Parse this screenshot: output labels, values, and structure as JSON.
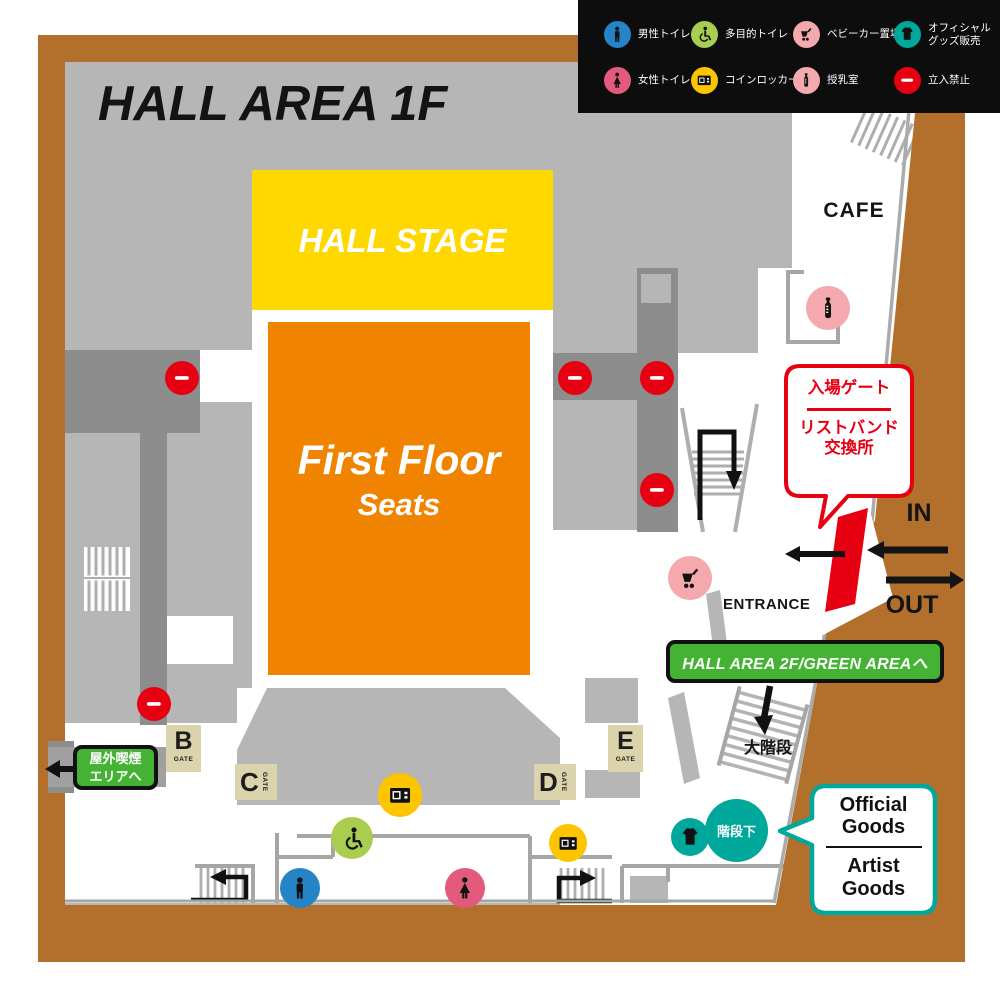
{
  "title": "HALL AREA 1F",
  "legend": {
    "items": [
      {
        "label": "男性トイレ",
        "icon": "male",
        "color": "#2583c6"
      },
      {
        "label": "多目的トイレ",
        "icon": "wheelchair",
        "color": "#a8cd50"
      },
      {
        "label": "ベビーカー置場",
        "icon": "stroller",
        "color": "#f3a9ad"
      },
      {
        "label": "オフィシャル\nグッズ販売",
        "icon": "tshirt",
        "color": "#00a79b"
      },
      {
        "label": "女性トイレ",
        "icon": "female",
        "color": "#e25a7c"
      },
      {
        "label": "コインロッカー",
        "icon": "locker",
        "color": "#fcc500"
      },
      {
        "label": "授乳室",
        "icon": "bottle",
        "color": "#f3a9ad"
      },
      {
        "label": "立入禁止",
        "icon": "no-entry",
        "color": "#e60012"
      }
    ]
  },
  "map": {
    "stage": "HALL STAGE",
    "seats1": "First Floor",
    "seats2": "Seats",
    "cafe": "CAFE",
    "entrance": "ENTRANCE",
    "in": "IN",
    "out": "OUT",
    "big_stairs": "大階段",
    "under_stairs": "階段下",
    "gates": [
      {
        "letter": "B",
        "word": "GATE"
      },
      {
        "letter": "C",
        "word": "GATE"
      },
      {
        "letter": "D",
        "word": "GATE"
      },
      {
        "letter": "E",
        "word": "GATE"
      }
    ],
    "markers": [
      "no-entry",
      "no-entry",
      "no-entry",
      "no-entry",
      "no-entry",
      "bottle",
      "stroller",
      "locker",
      "locker",
      "wheelchair",
      "male",
      "female",
      "tshirt"
    ]
  },
  "callouts": {
    "entry": {
      "line1": "入場ゲート",
      "line2": "リストバンド",
      "line3": "交換所"
    },
    "to2f": "HALL AREA 2F/GREEN AREAへ",
    "smoking": {
      "line1": "屋外喫煙",
      "line2": "エリアへ"
    },
    "goods": {
      "line1": "Official",
      "line2": "Goods",
      "line3": "Artist",
      "line4": "Goods"
    }
  },
  "colors": {
    "frame_brown": "#b2702c",
    "floor_gray": "#b6b6b6",
    "corridor_gray": "#8d8d8d",
    "stage_yellow": "#ffd800",
    "seats_orange": "#f08300",
    "alert_red": "#e60012",
    "badge_green": "#44b233",
    "goods_teal": "#00a79b",
    "male_blue": "#2583c6",
    "female_pink": "#e25a7c",
    "soft_pink": "#f3a9ad",
    "multi_lime": "#a8cd50",
    "locker_yellow": "#fcc500",
    "gate_beige": "#dad3ab",
    "legend_black": "#0d0d0d"
  }
}
